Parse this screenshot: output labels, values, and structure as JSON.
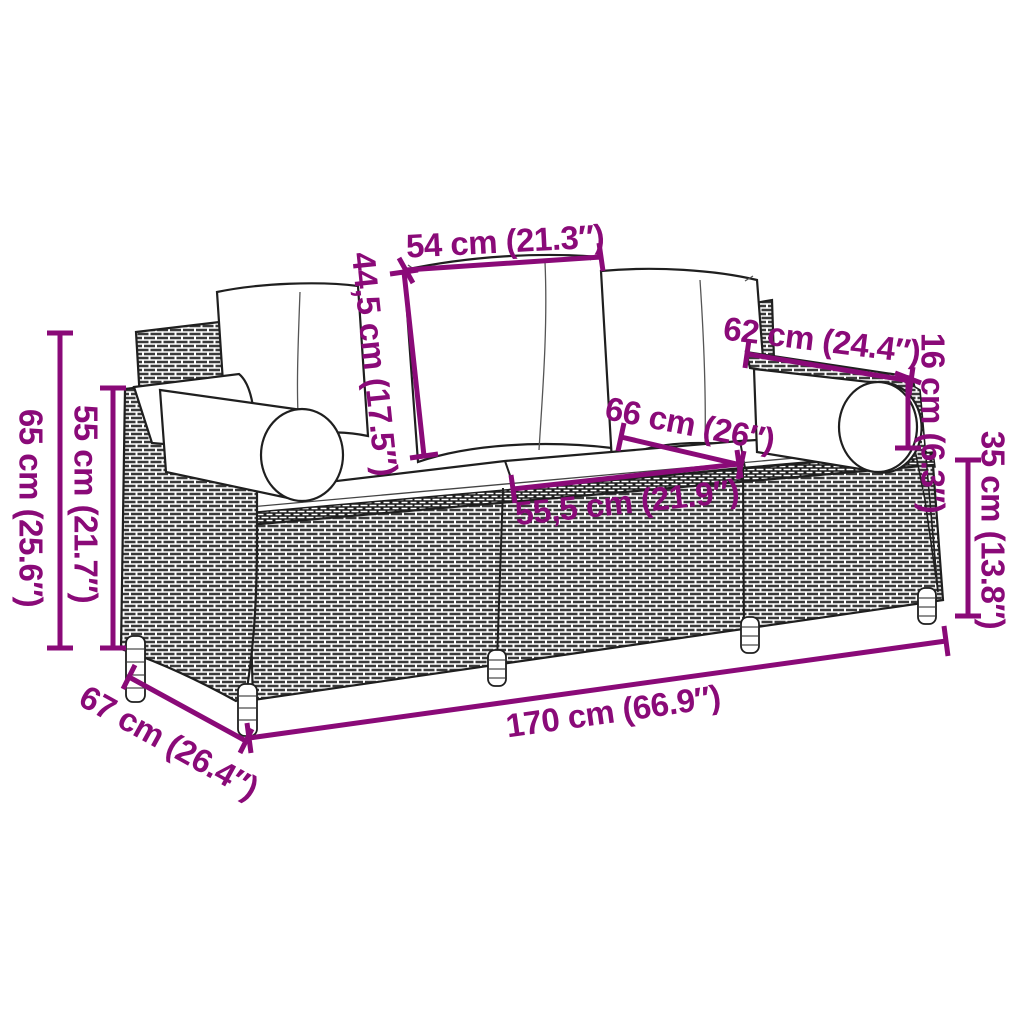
{
  "diagram": {
    "kind": "product-dimension-drawing",
    "subject": "rattan garden sofa line drawing with cushions",
    "background_color": "#ffffff",
    "accent_color": "#8A0A78",
    "line_color": "#1f1f1f",
    "dimensions": {
      "cushion_top_width": {
        "label": "54 cm (21.3″)"
      },
      "backrest_height": {
        "label": "44,5 cm (17.5″)"
      },
      "armrest_length": {
        "label": "62 cm (24.4″)"
      },
      "bolster_height": {
        "label": "16 cm (6.3″)"
      },
      "seat_depth": {
        "label": "66 cm (26″)"
      },
      "seat_cushion_width": {
        "label": "55,5 cm (21.9″)"
      },
      "base_height": {
        "label": "35 cm (13.8″)"
      },
      "total_height": {
        "label": "65 cm (25.6″)"
      },
      "armrest_height": {
        "label": "55 cm (21.7″)"
      },
      "depth": {
        "label": "67 cm (26.4″)"
      },
      "total_width": {
        "label": "170 cm (66.9″)"
      }
    }
  }
}
